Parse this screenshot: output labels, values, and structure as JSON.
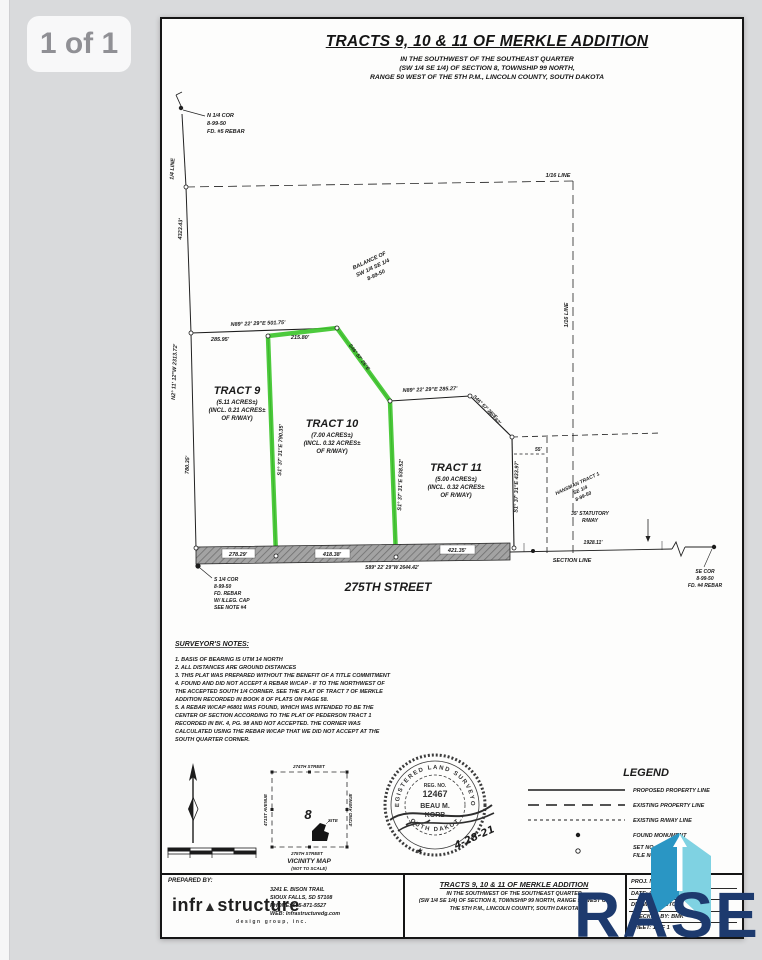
{
  "viewer": {
    "page_badge": "1 of 1"
  },
  "watermark": {
    "brand": "RASE"
  },
  "header": {
    "title": "TRACTS 9, 10 & 11 OF MERKLE ADDITION",
    "sub1": "IN THE SOUTHWEST OF THE SOUTHEAST QUARTER",
    "sub2": "(SW 1/4 SE 1/4) OF SECTION 8, TOWNSHIP 99 NORTH,",
    "sub3": "RANGE 50 WEST OF THE 5TH  P.M., LINCOLN COUNTY, SOUTH DAKOTA"
  },
  "plat": {
    "n_cor": [
      "N 1/4 COR",
      "8-99-50",
      "FD. #5 REBAR"
    ],
    "s_cor": [
      "S 1/4 COR",
      "8-99-50",
      "FD. REBAR",
      "W/ ILLEG. CAP",
      "SEE NOTE #4"
    ],
    "se_cor": [
      "SE COR",
      "8-99-50",
      "FD. #4 REBAR"
    ],
    "quarter_line": "1/4 LINE",
    "sixteenth_top": "1/16 LINE",
    "sixteenth_right": "1/16 LINE",
    "dim_4323": "4323.43'",
    "west_line": "N2° 11' 12\"W  2313.72'",
    "dim_780": "780.35'",
    "north_line": "N89° 22' 29\"E  501.75'",
    "dim_285": "285.95'",
    "dim_215": "215.80'",
    "diag_t10": "S46° 57' 25\"E",
    "mid_line": "N89° 22' 29\"E  285.27'",
    "diag_t11": "S46° 57' 25\"E",
    "diag_t11_dist": "101.62'",
    "bdy_9_10": "S1° 37' 31\"E  790.35'",
    "bdy_10_11": "S1° 37' 31\"E  538.52'",
    "bdy_11_e": "S1° 37' 31\"E  433.97'",
    "dim_55": "55'",
    "balance": [
      "BALANCE OF",
      "SW 1/4 SE 1/4",
      "8-99-50"
    ],
    "hansman": [
      "HANSMAN TRACT 1",
      "SE 1/4",
      "8-99-50"
    ],
    "statutory": [
      "35' STATUTORY",
      "R/WAY"
    ],
    "tract9": [
      "TRACT 9",
      "(5.11 ACRES±)",
      "(INCL. 0.21 ACRES±",
      "OF R/WAY)"
    ],
    "tract10": [
      "TRACT 10",
      "(7.00 ACRES±)",
      "(INCL. 0.32 ACRES±",
      "OF R/WAY)"
    ],
    "tract11": [
      "TRACT 11",
      "(5.00 ACRES±)",
      "(INCL. 0.32 ACRES±",
      "OF R/WAY)"
    ],
    "street_segs": [
      "278.29'",
      "418.38'",
      "421.35'"
    ],
    "street_bearing": "S89° 22' 29\"W  2644.42'",
    "street_name": "275TH STREET",
    "dim_1928": "1928.11'",
    "section_line": "SECTION LINE"
  },
  "notes": {
    "heading": "SURVEYOR'S NOTES:",
    "lines": [
      "1. BASIS OF BEARING IS UTM 14 NORTH",
      "2. ALL DISTANCES ARE GROUND DISTANCES",
      "3. THIS PLAT WAS PREPARED WITHOUT THE BENEFIT OF A TITLE COMMITMENT",
      "4. FOUND AND DID NOT ACCEPT A REBAR W/CAP - 8' TO THE NORTHWEST OF",
      "THE ACCEPTED SOUTH 1/4 CORNER. SEE THE PLAT OF TRACT 7 OF MERKLE",
      "ADDITION RECORDED IN BOOK 8 OF PLATS ON PAGE 58.",
      "5. A REBAR W/CAP #6801 WAS FOUND, WHICH WAS INTENDED TO BE THE",
      "CENTER OF SECTION ACCORDING TO THE PLAT OF PEDERSON TRACT 1",
      "RECORDED IN BK. 4, PG. 98 AND NOT ACCEPTED. THE CORNER WAS",
      "CALCULATED USING THE REBAR W/CAP THAT WE DID NOT ACCEPT AT THE",
      "SOUTH QUARTER CORNER."
    ]
  },
  "vicinity": {
    "top": "274TH STREET",
    "bottom": "275TH STREET",
    "left": "471ST AVENUE",
    "right": "472ND AVENUE",
    "section": "8",
    "site": "SITE",
    "caption": "VICINITY MAP",
    "scale_note": "(NOT TO SCALE)"
  },
  "seal": {
    "arc_top": "REGISTERED LAND SURVEYOR",
    "reg_label": "REG. NO.",
    "reg_no": "12467",
    "name1": "BEAU M.",
    "name2": "KORB",
    "arc_bottom": "SOUTH DAKOTA",
    "date": "4-28-21",
    "star": "★"
  },
  "legend": {
    "title": "LEGEND",
    "items": [
      "PROPOSED PROPERTY LINE",
      "EXISTING PROPERTY LINE",
      "EXISTING R/WAY LINE",
      "FOUND MONUMENT",
      "SET NO.",
      "FILE NO."
    ]
  },
  "titleblock": {
    "prepared_by": "PREPARED BY:",
    "firm_a": "infr",
    "firm_tri": "▲",
    "firm_b": "structure",
    "firm_sub": "design group, inc.",
    "addr": [
      "3241 E. BISON TRAIL",
      "SIOUX FALLS, SD 57108",
      "PHONE: 605-871-5527",
      "WEB: Infrastructuredg.com"
    ],
    "title": "TRACTS 9, 10 & 11 OF MERKLE ADDITION",
    "sub1": "IN THE SOUTHWEST OF THE SOUTHEAST QUARTER",
    "sub2": "(SW 1/4 SE 1/4) OF SECTION 8, TOWNSHIP 99 NORTH, RANGE 50 WEST OF",
    "sub3": "THE 5TH  P.M., LINCOLN COUNTY, SOUTH DAKOTA",
    "info": [
      "PROJ. NO:",
      "DATE: 04-28-21",
      "DRAWN BY: BTC",
      "CHECKED BY: BMK",
      "SHEET: 1 OF 1"
    ]
  },
  "colors": {
    "highlight": "#3ec52d",
    "brand_navy": "#1d3a6e",
    "logo_dark": "#2a96c4",
    "logo_light": "#7fd2e2"
  }
}
